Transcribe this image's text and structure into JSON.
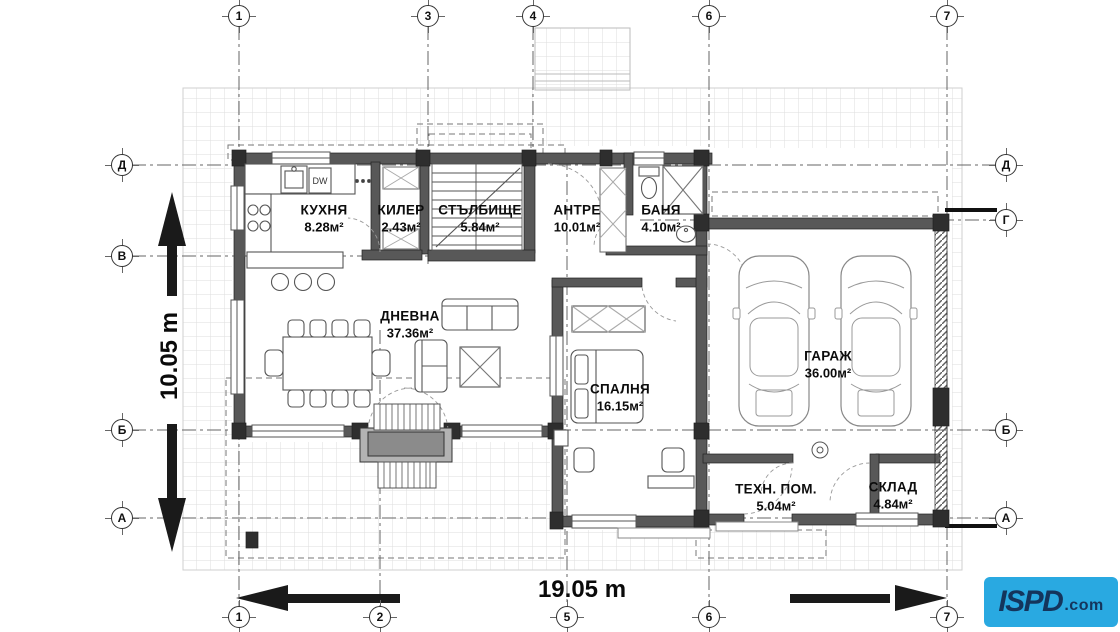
{
  "grid": {
    "top": [
      "1",
      "3",
      "4",
      "6",
      "7"
    ],
    "bottom": [
      "1",
      "2",
      "5",
      "6",
      "7"
    ],
    "left": [
      "Д",
      "В",
      "Б",
      "А"
    ],
    "right": [
      "Д",
      "Г",
      "Б",
      "А"
    ]
  },
  "rooms": [
    {
      "name": "КУХНЯ",
      "area": "8.28м²"
    },
    {
      "name": "КИЛЕР",
      "area": "2.43м²"
    },
    {
      "name": "СТЪЛБИЩЕ",
      "area": "5.84м²"
    },
    {
      "name": "АНТРЕ",
      "area": "10.01м²"
    },
    {
      "name": "БАНЯ",
      "area": "4.10м²"
    },
    {
      "name": "ДНЕВНА",
      "area": "37.36м²"
    },
    {
      "name": "СПАЛНЯ",
      "area": "16.15м²"
    },
    {
      "name": "ГАРАЖ",
      "area": "36.00м²"
    },
    {
      "name": "ТЕХН. ПОМ.",
      "area": "5.04м²"
    },
    {
      "name": "СКЛАД",
      "area": "4.84м²"
    }
  ],
  "dimensions": {
    "horizontal": "19.05 m",
    "vertical": "10.05 m"
  },
  "fixtures": {
    "dishwasher_label": "DW"
  },
  "logo": {
    "name": "ISPD",
    "tld": ".com",
    "background": "#29a9e1",
    "text_color": "#14355c"
  },
  "colors": {
    "wall": "#555555",
    "grid_line": "#666666",
    "paving_line": "#dedede"
  }
}
